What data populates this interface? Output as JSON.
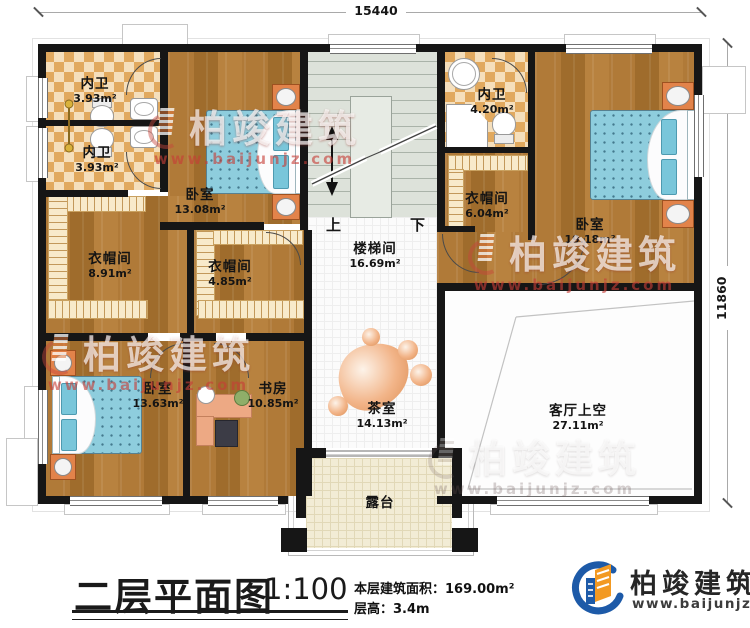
{
  "plan": {
    "dim_top": "15440",
    "dim_right": "11860",
    "stair_up": "上",
    "stair_down": "下",
    "rooms": [
      {
        "id": "bath-top-1",
        "name": "内卫",
        "area": "3.93m²"
      },
      {
        "id": "bath-top-2",
        "name": "内卫",
        "area": "3.93m²"
      },
      {
        "id": "bedroom-top",
        "name": "卧室",
        "area": "13.08m²"
      },
      {
        "id": "cloak-left",
        "name": "衣帽间",
        "area": "8.91m²"
      },
      {
        "id": "cloak-mid",
        "name": "衣帽间",
        "area": "4.85m²"
      },
      {
        "id": "stair-hall",
        "name": "楼梯间",
        "area": "16.69m²"
      },
      {
        "id": "bath-right",
        "name": "内卫",
        "area": "4.20m²"
      },
      {
        "id": "cloak-right",
        "name": "衣帽间",
        "area": "6.04m²"
      },
      {
        "id": "bedroom-right",
        "name": "卧室",
        "area": "19.18m²"
      },
      {
        "id": "bedroom-bottom-left",
        "name": "卧室",
        "area": "13.63m²"
      },
      {
        "id": "study",
        "name": "书房",
        "area": "10.85m²"
      },
      {
        "id": "tea-room",
        "name": "茶室",
        "area": "14.13m²"
      },
      {
        "id": "living-void",
        "name": "客厅上空",
        "area": "27.11m²"
      },
      {
        "id": "terrace",
        "name": "露台"
      }
    ]
  },
  "titleblock": {
    "title": "二层平面图",
    "scale": "1:100",
    "floor_area_label": "本层建筑面积：",
    "floor_area_value": "169.00m²",
    "floor_height_label": "层高：",
    "floor_height_value": "3.4m"
  },
  "branding": {
    "company": "柏竣建筑",
    "website": "www.baijunjz.com"
  },
  "watermark": {
    "company": "柏竣建筑",
    "website": "www.baijunjz.com"
  },
  "colors": {
    "wall": "#161616",
    "wood": "#ab7433",
    "checker_light": "#f5dfbc",
    "checker_dark": "#e1a95f",
    "bed_blue": "#8ecddd",
    "logo_blue": "#1d5aa8",
    "logo_orange": "#f29922",
    "watermark_red": "#c63e37"
  }
}
